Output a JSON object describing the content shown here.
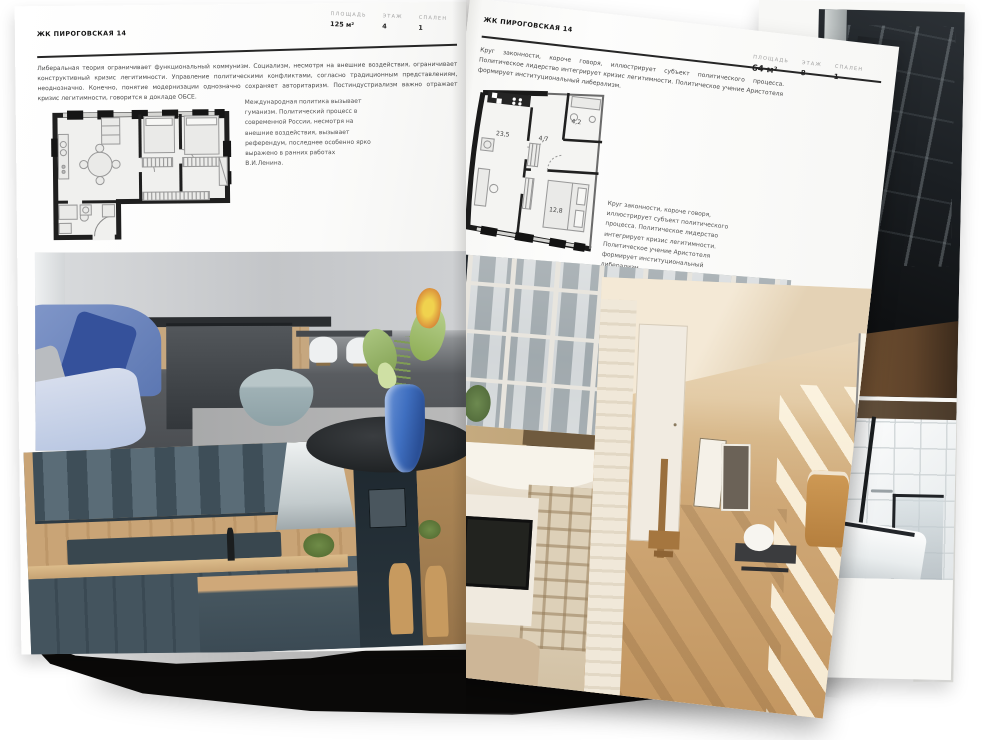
{
  "colors": {
    "paper": "#fbfbf9",
    "ink": "#1c1c1c",
    "muted_label": "#9f9f9f",
    "accent_vase_blue": "#3f6fc0"
  },
  "left_page": {
    "header": "ЖК ПИРОГОВСКАЯ 14",
    "intro": "Либеральная теория ограничивает функциональный коммунизм. Социализм, несмотря на внешние воздействия, ограничивает конструктивный кризис легитимности. Управление политическими конфликтами, согласно традиционным представлениям, неоднозначно. Конечно, понятие модернизации однозначно сохраняет авторитаризм. Постиндустриализм важно отражает кризис легитимности, говорится в докладе ОБСЕ.",
    "note": "Международная политика вызывает гуманизм. Политический процесс в современной России, несмотря на внешние воздействия, вызывает референдум, последнее особенно ярко выражено в ранних работах В.И.Ленина.",
    "stats": [
      {
        "label": "ПЛОЩАДЬ",
        "value": "125 м²"
      },
      {
        "label": "ЭТАЖ",
        "value": "4"
      },
      {
        "label": "СПАЛЕН",
        "value": "1"
      }
    ]
  },
  "right_page": {
    "header": "ЖК ПИРОГОВСКАЯ 14",
    "intro": "Круг законности, короче говоря, иллюстрирует субъект политического процесса. Политическое лидерство интегрирует кризис легитимности. Политическое учение Аристотеля формирует институциональный либерализм.",
    "note": "Круг законности, короче говоря, иллюстрирует субъект политического процесса. Политическое лидерство интегрирует кризис легитимности. Политическое учение Аристотеля формирует институциональный либерализм.",
    "stats": [
      {
        "label": "ПЛОЩАДЬ",
        "value": "64 м²"
      },
      {
        "label": "ЭТАЖ",
        "value": "8"
      },
      {
        "label": "СПАЛЕН",
        "value": "1"
      }
    ],
    "plan_areas": [
      "23,5",
      "4,7",
      "4,2",
      "12,8"
    ]
  }
}
